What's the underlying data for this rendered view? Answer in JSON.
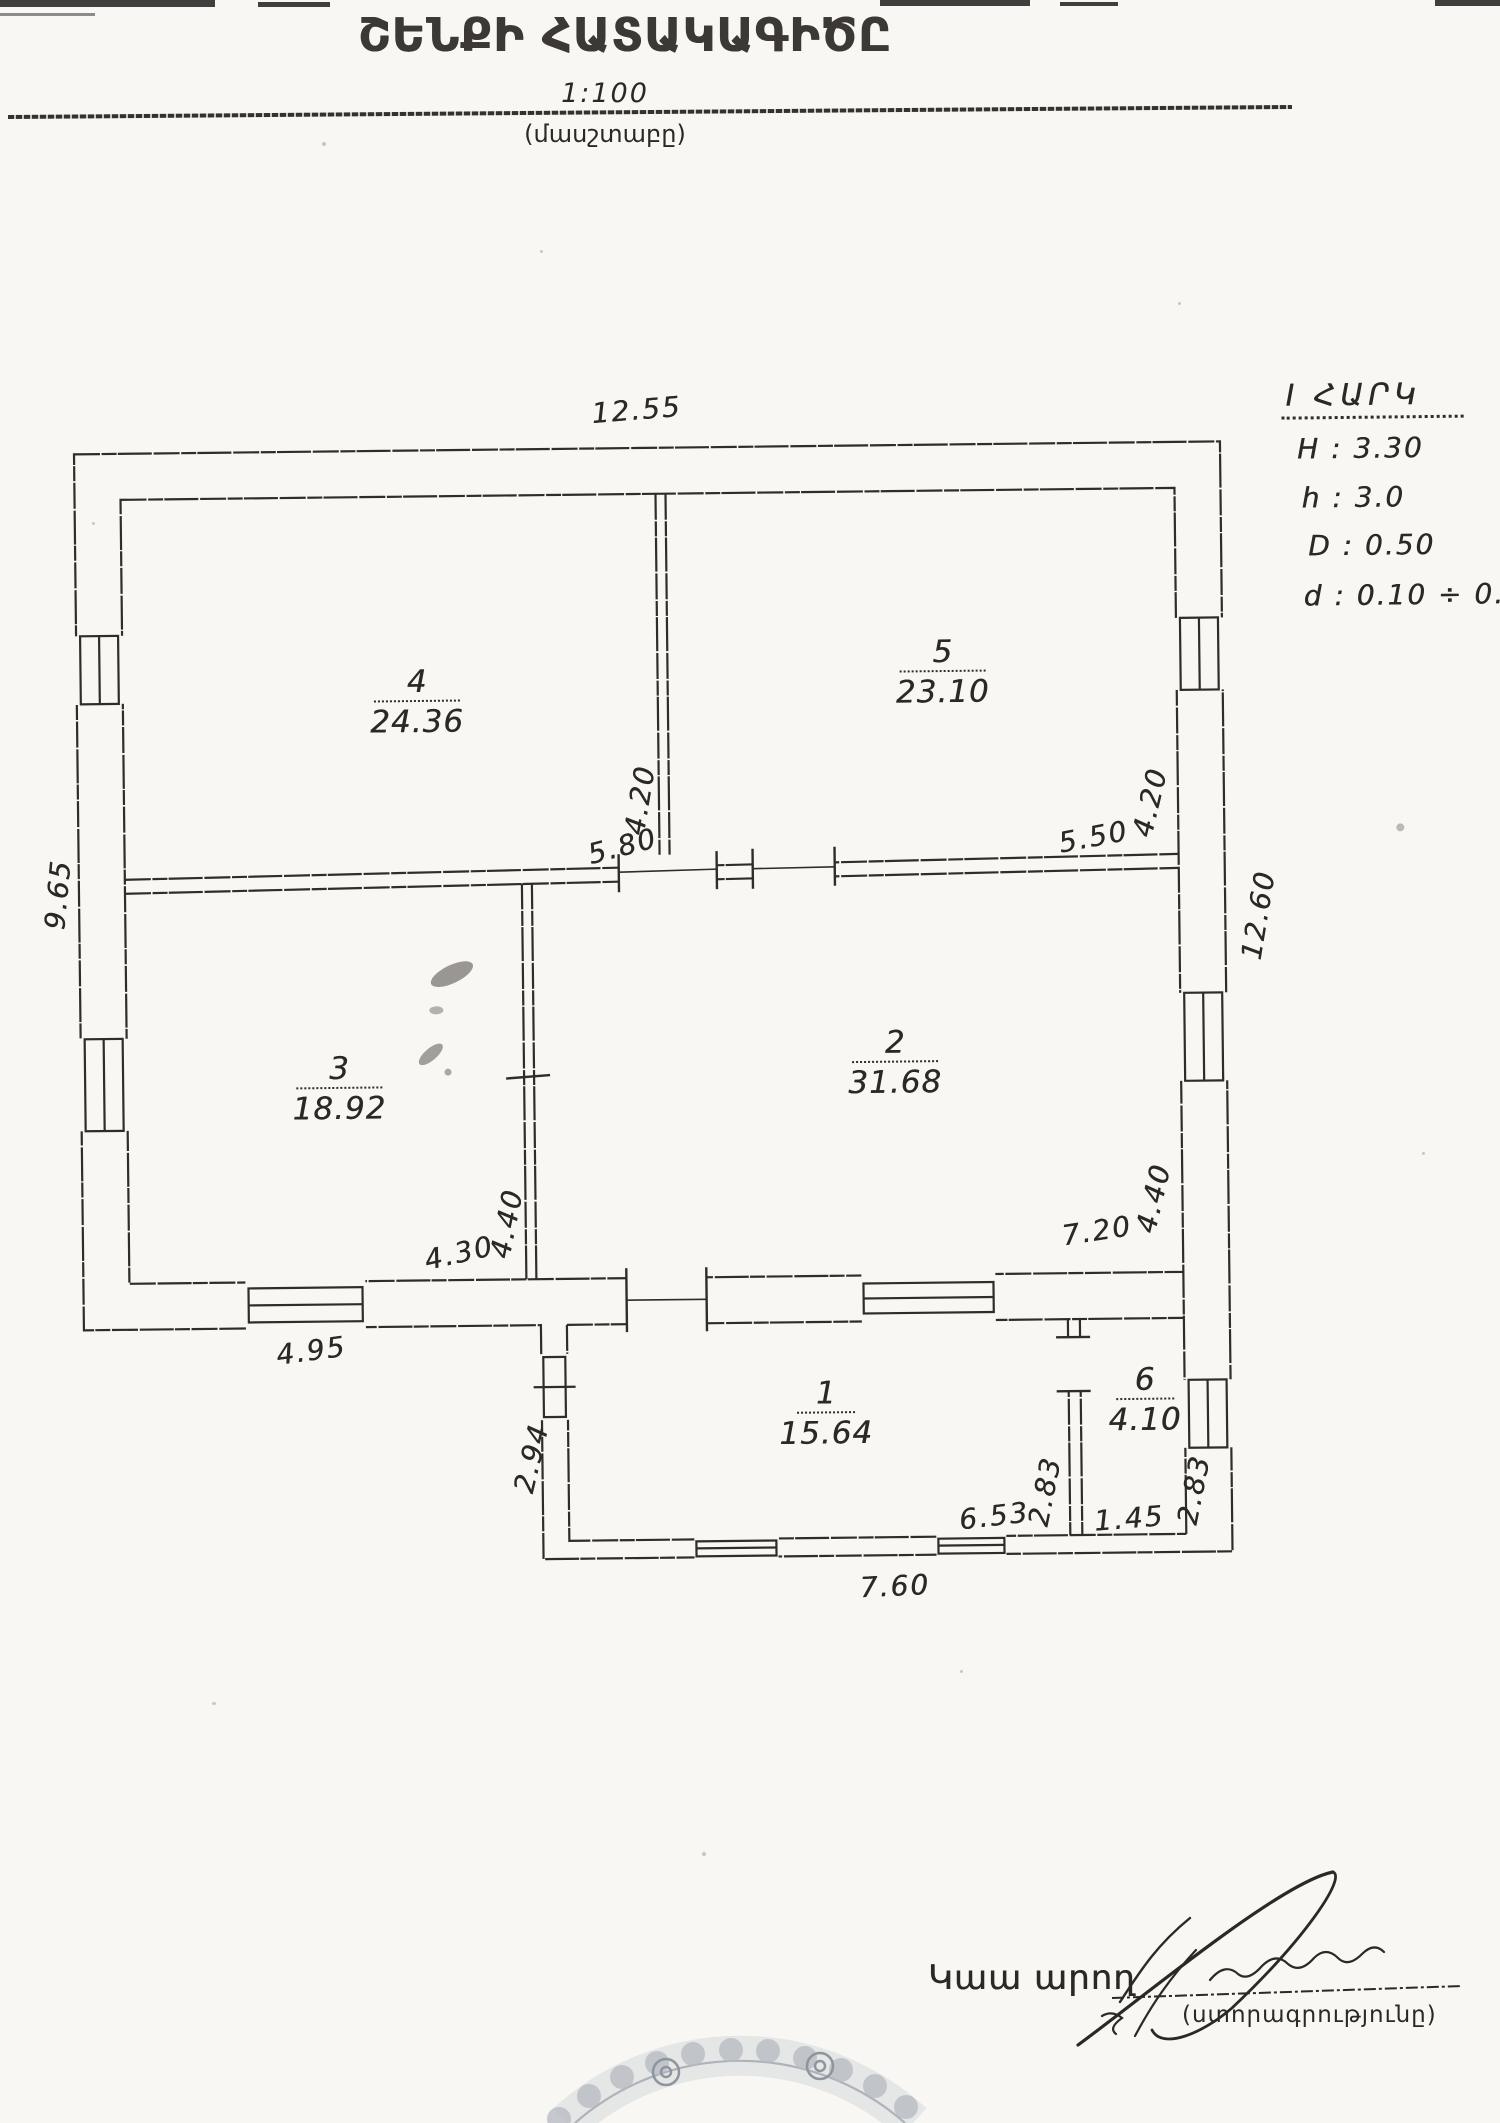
{
  "document": {
    "title": "ՇԵՆՔԻ ՀԱՏԱԿԱԳԻԾԸ",
    "scale": "1:100",
    "scale_caption": "(մասշտաբը)"
  },
  "notes": {
    "floor": "I ՀԱՐԿ",
    "H": "H : 3.30",
    "h": "h : 3.0",
    "D": "D : 0.50",
    "d": "d : 0.10 ÷ 0.20"
  },
  "rooms": [
    {
      "number": "4",
      "area": "24.36"
    },
    {
      "number": "5",
      "area": "23.10"
    },
    {
      "number": "3",
      "area": "18.92"
    },
    {
      "number": "2",
      "area": "31.68"
    },
    {
      "number": "1",
      "area": "15.64"
    },
    {
      "number": "6",
      "area": "4.10"
    }
  ],
  "dimensions": {
    "top": "12.55",
    "left": "9.65",
    "right": "12.60",
    "mid_wall_v": "4.20",
    "mid_left": "5.80",
    "mid_right": "5.50",
    "mid_right_v": "4.20",
    "low_wall_v": "4.40",
    "low_left": "4.30",
    "low_right": "7.20",
    "low_right_v": "4.40",
    "wing_offset": "4.95",
    "wing_left_v": "2.94",
    "wing_inner": "6.53",
    "wing_div_v": "2.83",
    "wing_room6": "1.45",
    "wing_right_v": "2.83",
    "wing_bottom": "7.60"
  },
  "footer": {
    "executor_label": "Կաա արող",
    "signature_caption": "(ստորագրությունը)"
  },
  "colors": {
    "ink": "#2f2d2a",
    "paper": "#f8f7f4",
    "stamp": "#b7bbc1"
  }
}
